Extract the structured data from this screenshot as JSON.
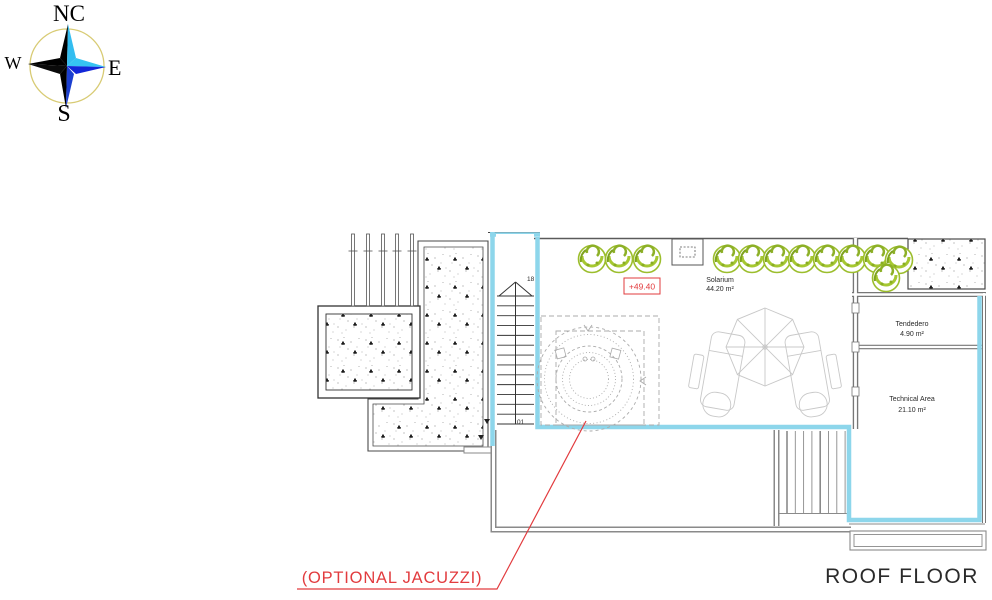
{
  "title": "ROOF FLOOR",
  "compass": {
    "north": "NC",
    "east": "E",
    "south": "S",
    "west": "W"
  },
  "rooms": [
    {
      "name": "Solarium",
      "area": "44.20 m²"
    },
    {
      "name": "Tendedero",
      "area": "4.90 m²"
    },
    {
      "name": "Technical Area",
      "area": "21.10 m²"
    }
  ],
  "annotations": {
    "level": "+49.40",
    "optional_jacuzzi": "(OPTIONAL JACUZZI)",
    "stair_top": "18",
    "stair_bottom": "01"
  },
  "colors": {
    "highlight_cyan": "#8dd6eb",
    "annotation_red": "#e23b3e",
    "tree_green": "#9cbe2d",
    "wall_gray": "#8a8a8a"
  },
  "trees": {
    "radius": 14,
    "positions": [
      [
        592,
        259
      ],
      [
        619,
        259
      ],
      [
        647,
        259
      ],
      [
        727,
        259
      ],
      [
        752,
        259
      ],
      [
        777,
        259
      ],
      [
        802,
        259
      ],
      [
        827,
        259
      ],
      [
        852,
        259
      ],
      [
        877,
        259
      ],
      [
        899,
        260
      ],
      [
        886,
        278
      ]
    ]
  },
  "stairs": {
    "tread_count": 14
  }
}
